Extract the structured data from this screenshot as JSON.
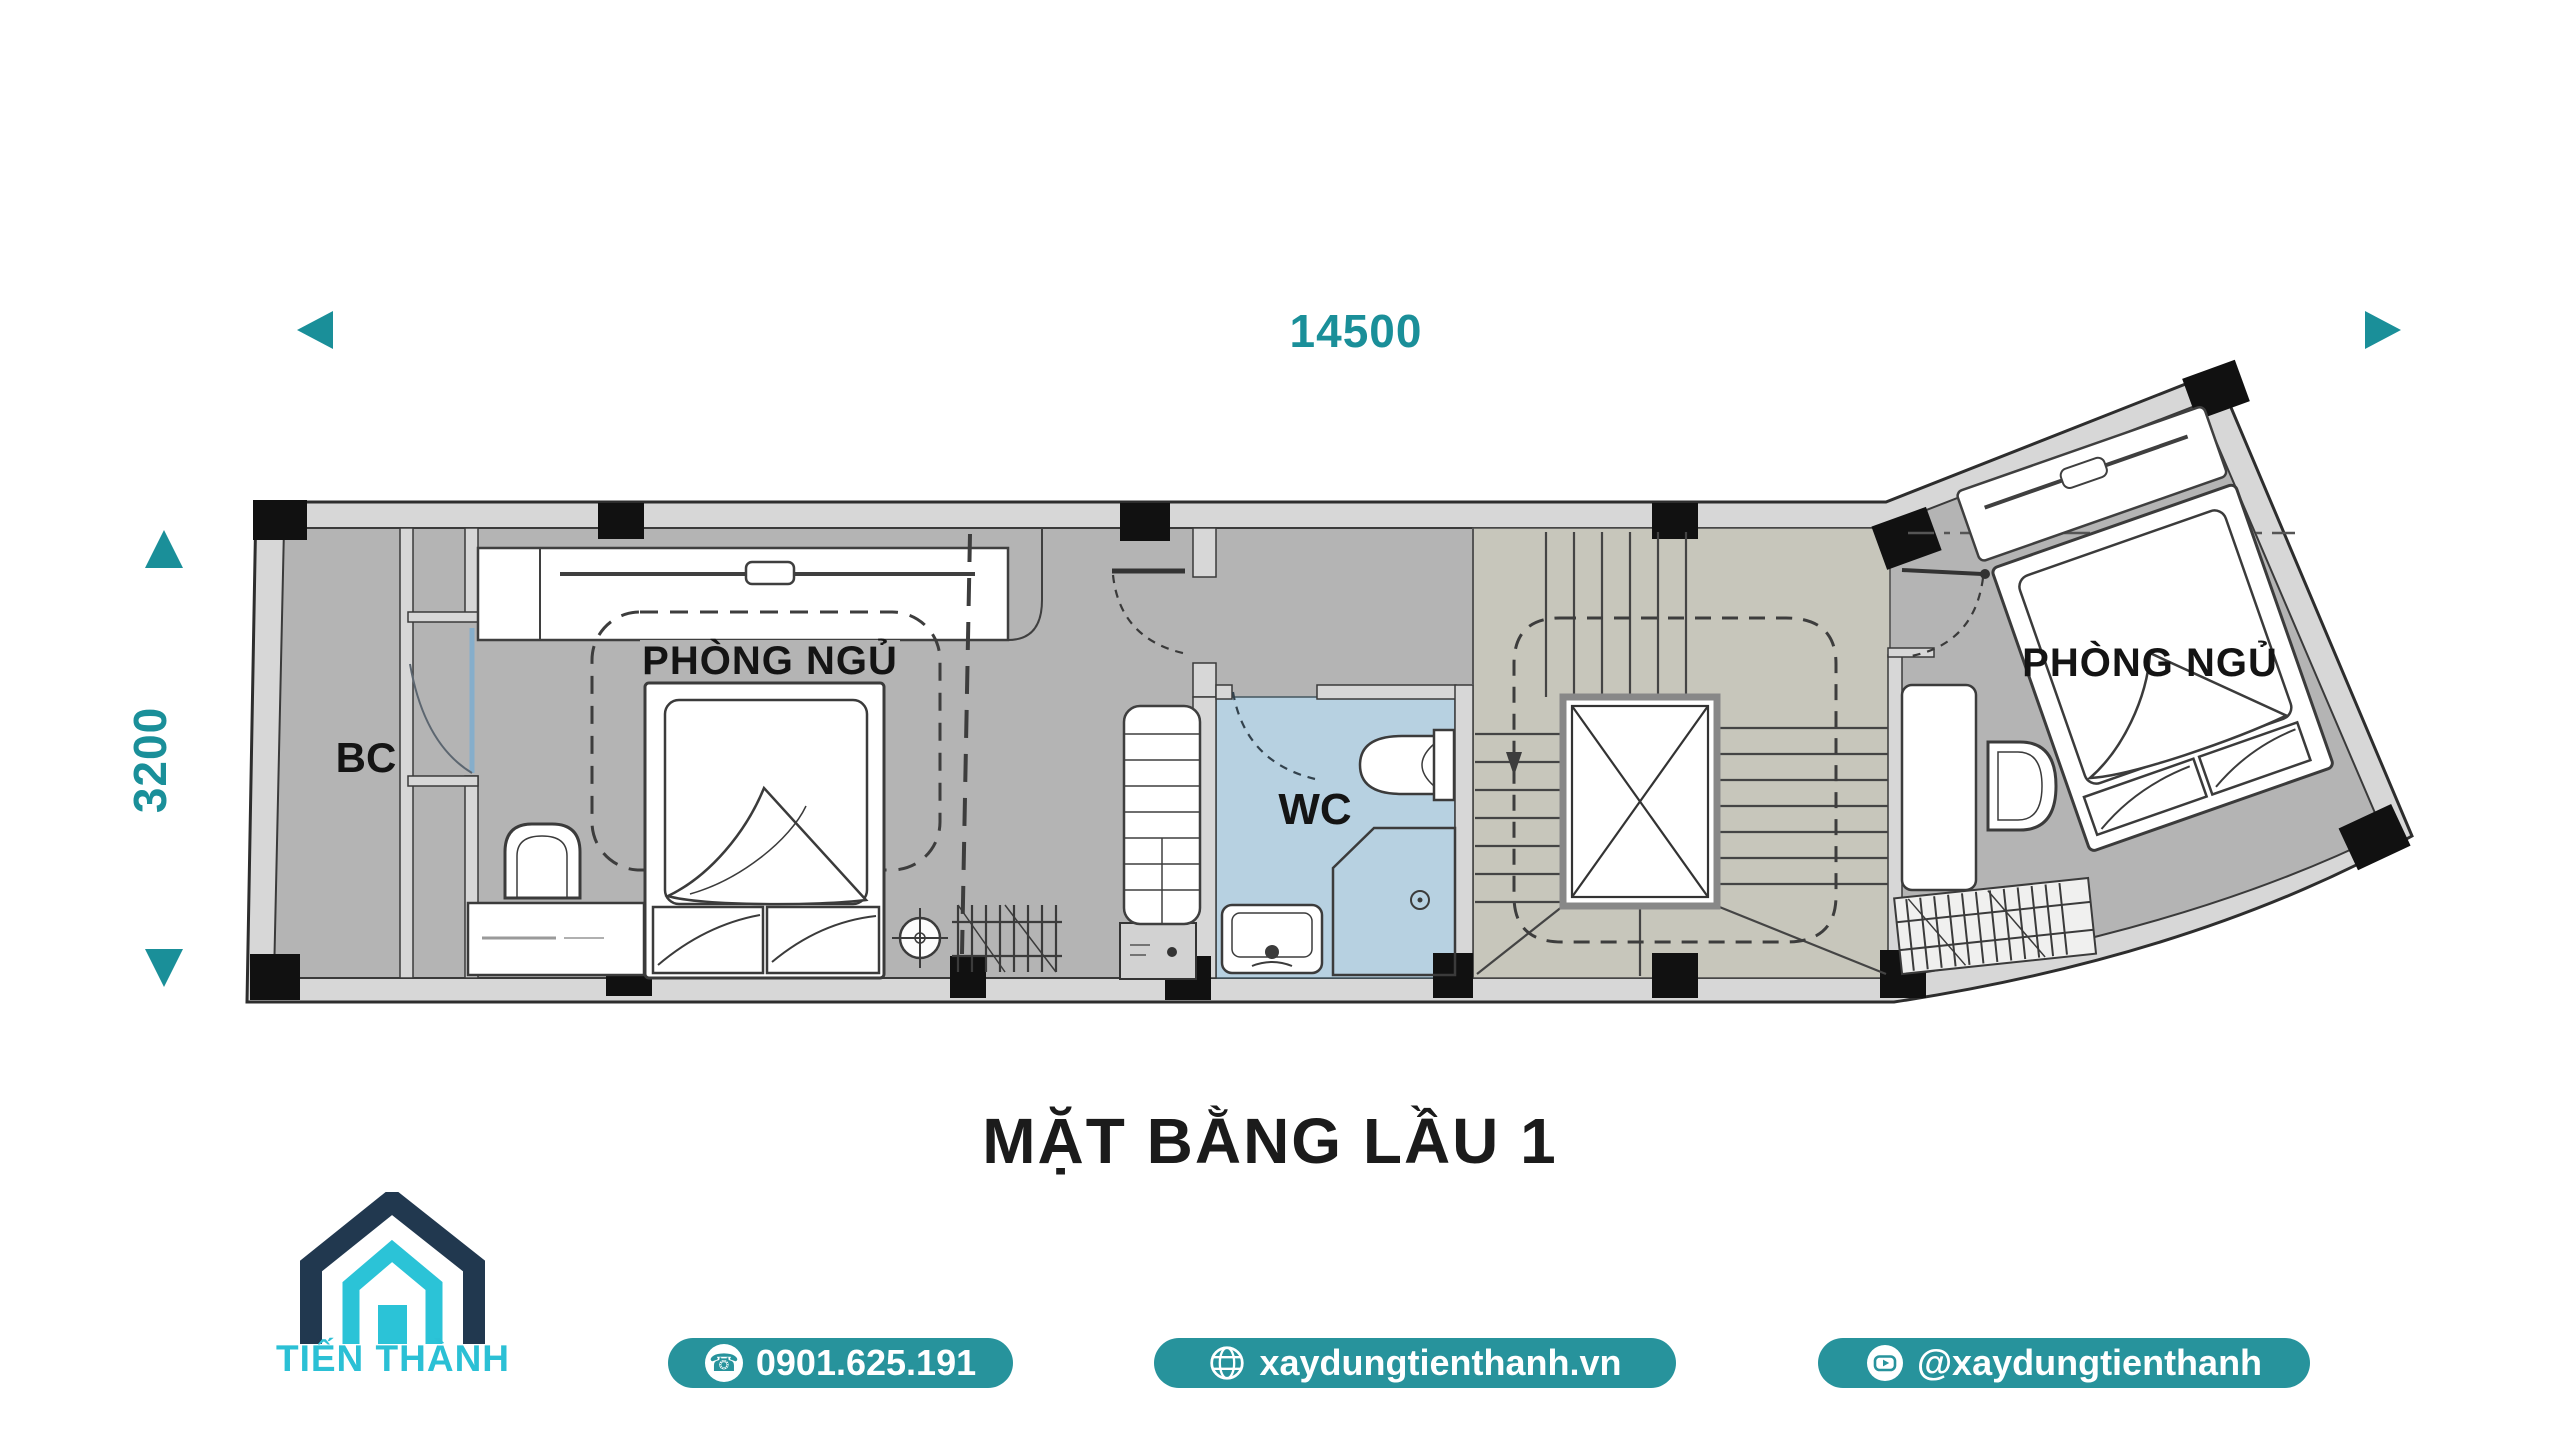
{
  "colors": {
    "teal_text": "#1a8f99",
    "pill_teal": "#27939c",
    "logo_navy": "#21384f",
    "logo_cyan": "#2bc3d7",
    "floor_gray": "#b4b4b4",
    "wall_gray": "#d7d7d7",
    "wc_floor_blue": "#b7d1e1",
    "stair_floor": "#c7c6bb",
    "ink": "#1b1b1b"
  },
  "dimensions": {
    "horizontal": "14500",
    "vertical": "3200"
  },
  "plan": {
    "rooms": {
      "balcony": {
        "label": "BC"
      },
      "bedroom_left": {
        "label": "PHÒNG NGỦ"
      },
      "wc": {
        "label": "WC"
      },
      "bedroom_right": {
        "label": "PHÒNG NGỦ"
      }
    }
  },
  "title": {
    "text": "MẶT BẰNG LẦU 1"
  },
  "footer": {
    "brand": {
      "name": "TIẾN THÀNH"
    },
    "contacts": [
      {
        "type": "phone",
        "label": "0901.625.191"
      },
      {
        "type": "website",
        "label": "xaydungtienthanh.vn"
      },
      {
        "type": "social",
        "label": "@xaydungtienthanh"
      }
    ]
  },
  "icons": {
    "phone_glyph": "☎"
  }
}
